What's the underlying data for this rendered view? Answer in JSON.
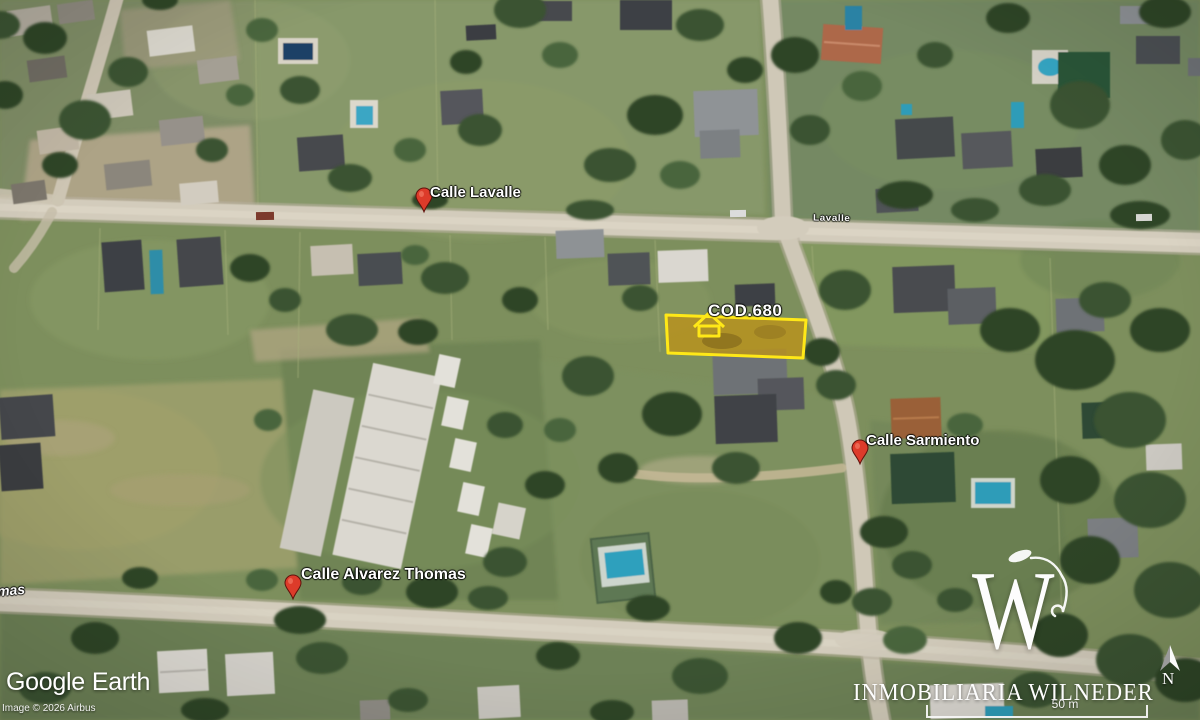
{
  "map": {
    "labels": {
      "lavalle": "Calle Lavalle",
      "lavalle_street": "Lavalle",
      "sarmiento": "Calle Sarmiento",
      "alvarez_thomas": "Calle Alvarez Thomas",
      "alvarez_thomas_fragment": "mas"
    },
    "lot": {
      "code": "COD.680"
    }
  },
  "branding": {
    "viewer_primary": "Google",
    "viewer_secondary": "Earth",
    "imagery_credit": "Image © 2026 Airbus",
    "agency_name": "INMOBILIARIA WILNEDER",
    "agency_monogram": "W"
  },
  "navigation": {
    "north_label": "N",
    "scale_label": "50 m"
  },
  "colors": {
    "lot_outline": "#ffe817",
    "lot_fill": "rgba(188,146,26,0.8)",
    "pin_red": "#dd3b2a",
    "road_tan": "#d3ccbc"
  }
}
